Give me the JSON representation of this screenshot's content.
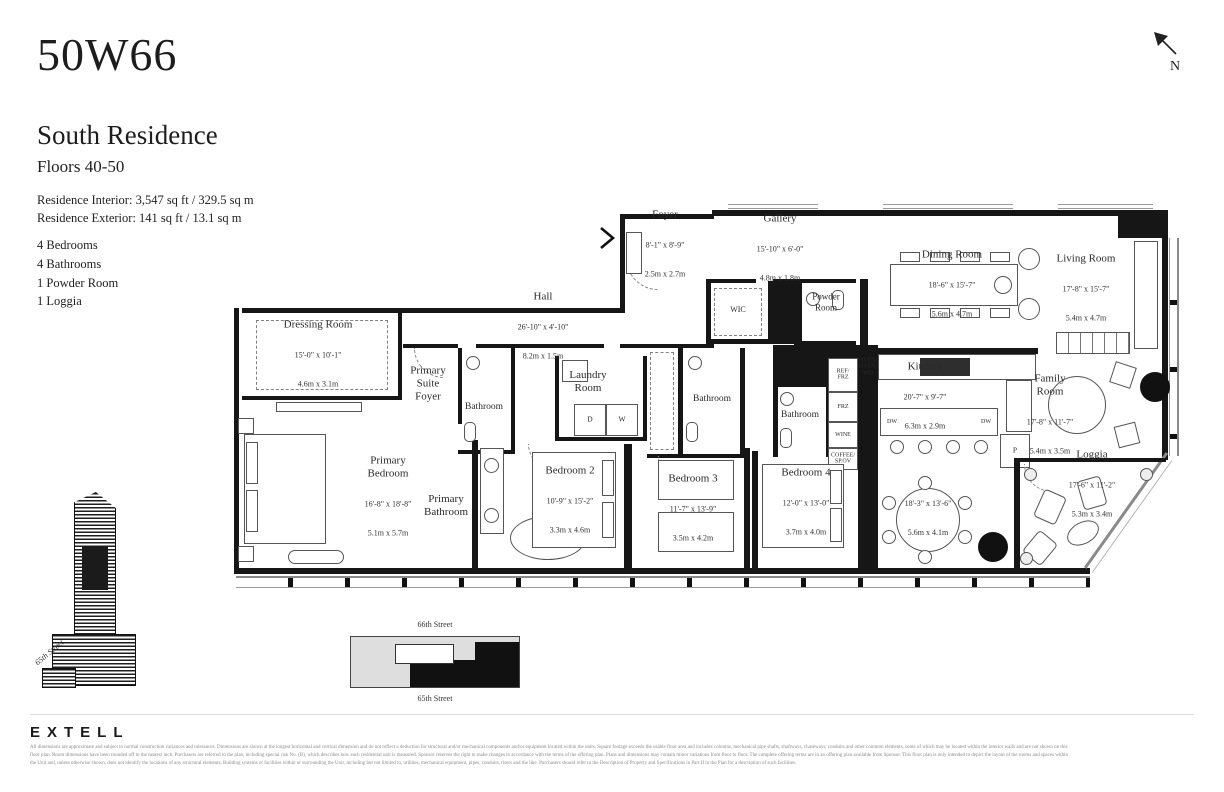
{
  "header": {
    "brand": "50W66",
    "residence": "South Residence",
    "floors": "Floors 40-50",
    "interior": "Residence Interior: 3,547 sq ft / 329.5 sq m",
    "exterior": "Residence Exterior: 141 sq ft / 13.1 sq m",
    "features": [
      "4 Bedrooms",
      "4 Bathrooms",
      "1 Powder Room",
      "1 Loggia"
    ]
  },
  "compass": {
    "label": "N"
  },
  "plan": {
    "rooms": {
      "foyer": {
        "name": "Foyer",
        "ft": "8'-1\" x 8'-9\"",
        "m": "2.5m x 2.7m"
      },
      "gallery": {
        "name": "Gallery",
        "ft": "15'-10\" x 6'-0\"",
        "m": "4.8m x 1.8m"
      },
      "hall": {
        "name": "Hall",
        "ft": "26'-10\" x 4'-10\"",
        "m": "8.2m x 1.5m"
      },
      "dressing": {
        "name": "Dressing Room",
        "ft": "15'-0\" x 10'-1\"",
        "m": "4.6m x 3.1m"
      },
      "primary_suite_foyer": {
        "name": "Primary\nSuite\nFoyer"
      },
      "primary_bedroom": {
        "name": "Primary\nBedroom",
        "ft": "16'-8\" x 18'-8\"",
        "m": "5.1m x 5.7m"
      },
      "primary_bathroom": {
        "name": "Primary\nBathroom"
      },
      "bathroom_a": {
        "name": "Bathroom"
      },
      "bathroom_b": {
        "name": "Bathroom"
      },
      "bathroom_c": {
        "name": "Bathroom"
      },
      "laundry": {
        "name": "Laundry\nRoom"
      },
      "wic": {
        "name": "WIC"
      },
      "powder": {
        "name": "Powder\nRoom"
      },
      "dining": {
        "name": "Dining Room",
        "ft": "18'-6\" x 15'-7\"",
        "m": "5.6m x 4.7m"
      },
      "living": {
        "name": "Living Room",
        "ft": "17'-8\" x 15'-7\"",
        "m": "5.4m x 4.7m"
      },
      "kitchen": {
        "name": "Kitchen",
        "ft": "20'-7\" x 9'-7\"",
        "m": "6.3m x 2.9m"
      },
      "family": {
        "name": "Family\nRoom",
        "ft": "17'-8\" x 11'-7\"",
        "m": "5.4m x 3.5m"
      },
      "breakfast": {
        "name": "",
        "ft": "18'-3\" x 13'-6\"",
        "m": "5.6m x 4.1m"
      },
      "loggia": {
        "name": "Loggia",
        "ft": "17'-6\" x 11'-2\"",
        "m": "5.3m x 3.4m"
      },
      "bedroom2": {
        "name": "Bedroom 2",
        "ft": "10'-9\" x 15'-2\"",
        "m": "3.3m x 4.6m"
      },
      "bedroom3": {
        "name": "Bedroom 3",
        "ft": "11'-7\" x 13'-9\"",
        "m": "3.5m x 4.2m"
      },
      "bedroom4": {
        "name": "Bedroom 4",
        "ft": "12'-0\" x 13'-0\"",
        "m": "3.7m x 4.0m"
      }
    },
    "labels": {
      "d": "D",
      "w": "W",
      "dw": "DW",
      "p": "P",
      "ref": "REF/\nFRZ",
      "frz": "FRZ",
      "wine": "WINE",
      "coffee": "COFFEE/\nSP.OV",
      "ovens": "OVEN/\nOVEN/\nWD"
    }
  },
  "locator": {
    "above": "66th Street",
    "below": "65th Street",
    "side": "65th Street"
  },
  "footer": {
    "logo": "EXTELL",
    "disclaimer": [
      "All dimensions are approximate and subject to normal construction variances and tolerances. Dimensions are shown at the longest horizontal and vertical dimension and do not reflect a deduction for structural and/or mechanical components and/or equipment located within the units. Square footage exceeds the usable floor area and includes columns, mechanical pipe shafts, shaftways, chaseways, conduits and other common elements, some of which may be located within the interior walls and are not shown on this",
      "floor plan.  Room dimensions have been rounded off to the nearest inch. Purchasers are referred to the plan, including special risk No. (B), which describes how each residential unit is measured. Sponsor reserves the right to make changes in accordance with the terms of the offering plan. Plans and dimensions may contain minor variations from floor to floor. The complete offering terms are in an offering plan available from Sponsor. This floor plan is only intended to depict the layout of the rooms and spaces within",
      "the Unit and, unless otherwise shown, does not identify the locations of any structural elements, Building systems or facilities within or surrounding the Unit, including but not limited to, utilities, mechanical equipment, pipes, conduits, risers and the like. Purchasers should refer to the Description of Property and Specifications in Part II in the Plan for a description of such facilities."
    ]
  }
}
